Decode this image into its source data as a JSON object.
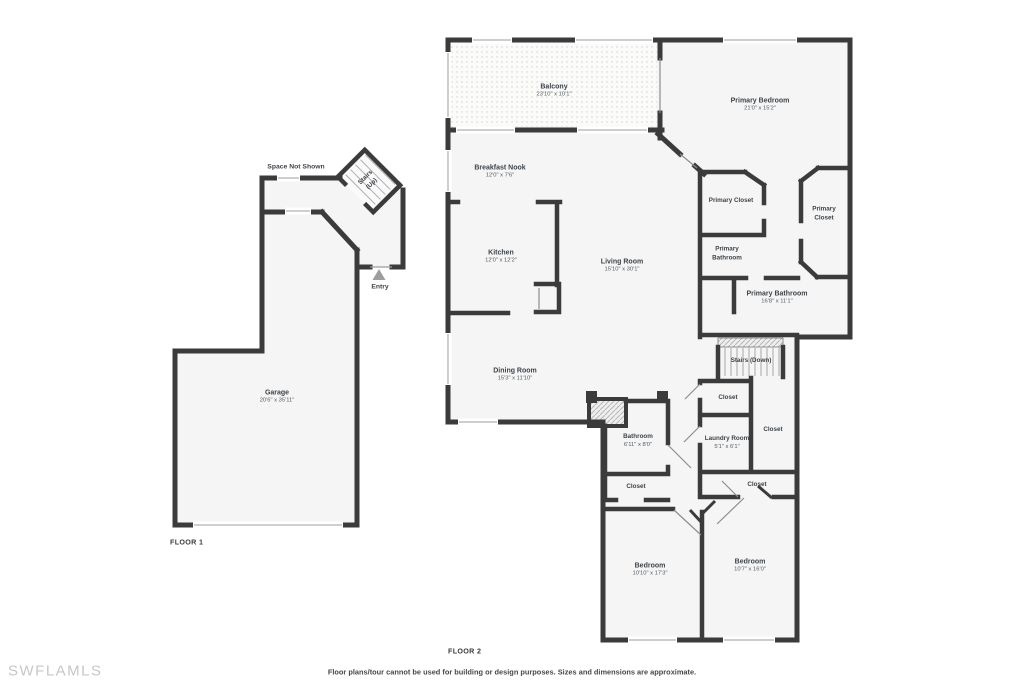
{
  "watermark": "SWFLAMLS",
  "footer": {
    "disclaimer": "Floor plans/tour cannot be used for building or design purposes. Sizes and dimensions are approximate."
  },
  "colors": {
    "wall": "#3b3b3b",
    "floor": "#f5f5f5",
    "background": "#ffffff"
  },
  "floor1": {
    "title": "FLOOR 1",
    "annotations": {
      "space_not_shown": "Space Not Shown",
      "entry": "Entry"
    },
    "rooms": {
      "garage": {
        "name": "Garage",
        "dims": "20'6\" x 35'11\""
      },
      "stairs_up": {
        "name": "Stairs (Up)"
      }
    }
  },
  "floor2": {
    "title": "FLOOR 2",
    "rooms": {
      "balcony": {
        "name": "Balcony",
        "dims": "23'10\" x 10'1\""
      },
      "primary_bedroom": {
        "name": "Primary Bedroom",
        "dims": "21'0\" x 15'2\""
      },
      "breakfast_nook": {
        "name": "Breakfast Nook",
        "dims": "12'0\" x 7'6\""
      },
      "kitchen": {
        "name": "Kitchen",
        "dims": "12'0\" x 12'2\""
      },
      "living_room": {
        "name": "Living Room",
        "dims": "15'10\" x 30'1\""
      },
      "dining_room": {
        "name": "Dining Room",
        "dims": "15'3\" x 11'10\""
      },
      "primary_closet_left": {
        "name": "Primary Closet"
      },
      "primary_closet_right": {
        "name": "Primary Closet"
      },
      "primary_bathroom_small": {
        "name": "Primary Bathroom"
      },
      "primary_bathroom": {
        "name": "Primary Bathroom",
        "dims": "16'8\" x 11'1\""
      },
      "stairs_down": {
        "name": "Stairs (Down)"
      },
      "closet_hall_top": {
        "name": "Closet"
      },
      "closet_hall_right": {
        "name": "Closet"
      },
      "laundry_room": {
        "name": "Laundry Room",
        "dims": "5'1\" x 6'1\""
      },
      "closet_hall_bottom": {
        "name": "Closet"
      },
      "bathroom": {
        "name": "Bathroom",
        "dims": "6'11\" x 8'0\""
      },
      "closet_bathroom": {
        "name": "Closet"
      },
      "bedroom_left": {
        "name": "Bedroom",
        "dims": "10'10\" x 17'3\""
      },
      "bedroom_right": {
        "name": "Bedroom",
        "dims": "10'7\" x 16'0\""
      }
    }
  }
}
